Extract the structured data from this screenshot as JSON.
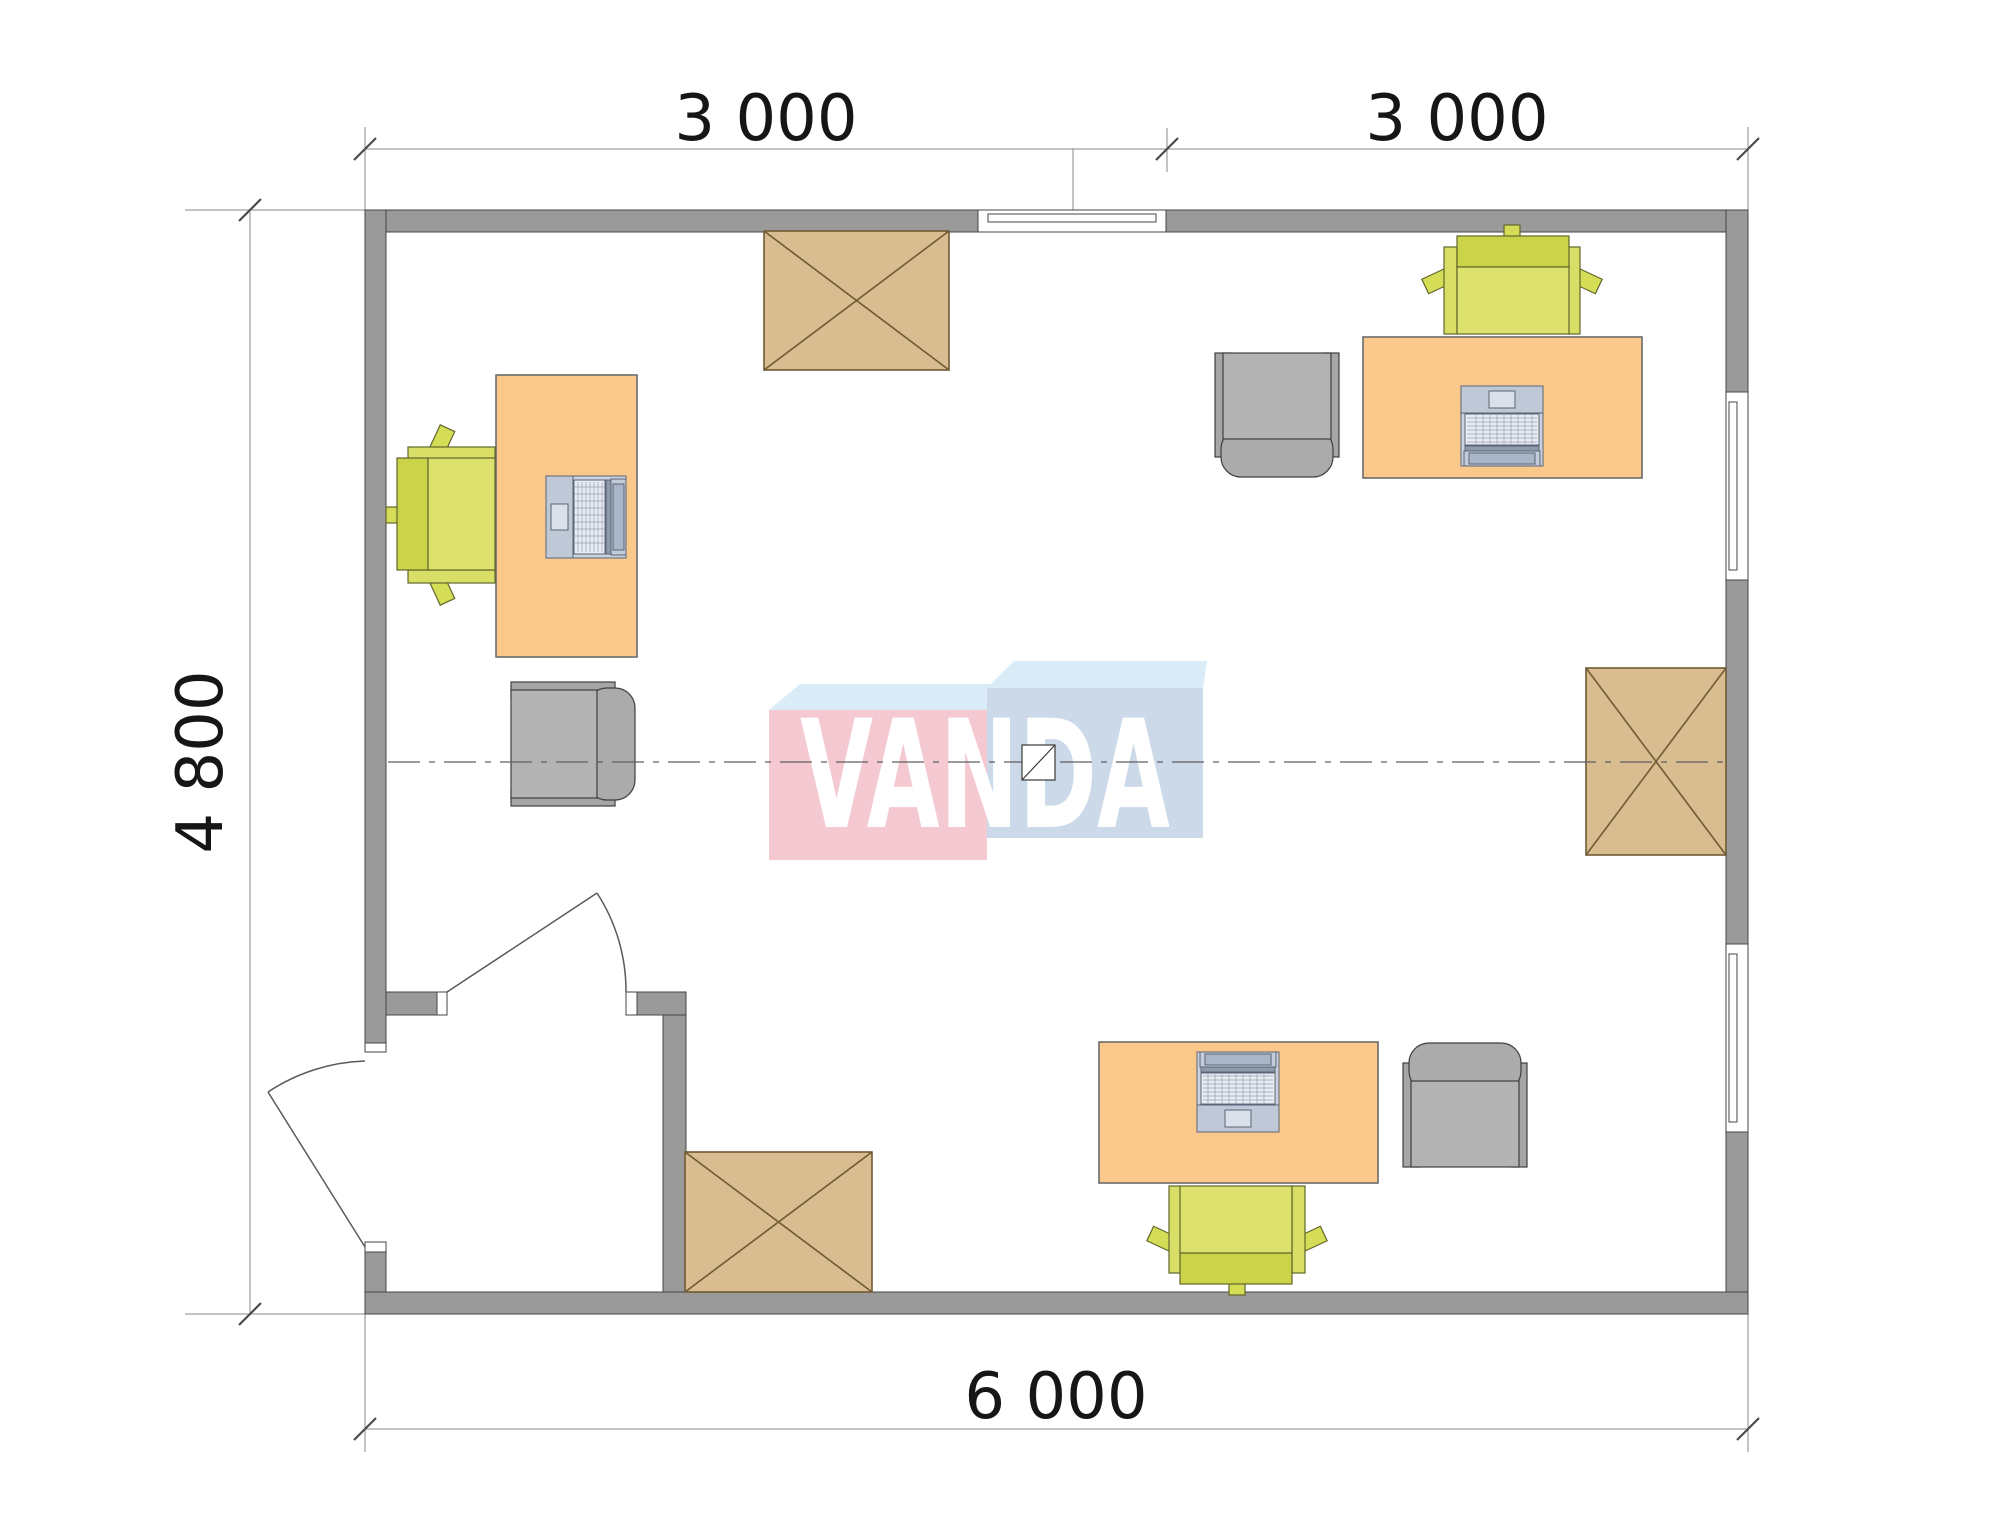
{
  "title": "Modular office floor plan 6000 x 4800 with furniture layout",
  "watermark": {
    "text": "VANDA"
  },
  "dimensions": {
    "top": {
      "segments": [
        {
          "label": "3 000"
        },
        {
          "label": "3 000"
        }
      ]
    },
    "left": {
      "label": "4 800"
    },
    "bottom": {
      "label": "6 000"
    }
  },
  "colors": {
    "wall": "#9A9A9A",
    "desk": "#FBC88B",
    "chair_green": "#D5DC55",
    "chair_green_back": "#CBD348",
    "chair_green_seat": "#DDE26F",
    "chair_green_armrest": "#D9DF66",
    "chair_gray": "#B3B3B3",
    "table_wood": "#D9BC90",
    "logo_pink": "#F4C9D1",
    "logo_blue": "#CBD9E9",
    "logo_top_face": "#D9ECF8",
    "dimension_text": "#161616",
    "centerline": "#5f5f5f"
  },
  "plan": {
    "rooms": [
      {
        "name": "main-office"
      },
      {
        "name": "entry-vestibule"
      }
    ],
    "symbols": [
      "desk",
      "office-chair",
      "guest-armchair",
      "laptop",
      "crossed-table",
      "window",
      "door-swing",
      "centerline",
      "module-joint-symbol"
    ],
    "counts": {
      "desks": 3,
      "office_chairs": 3,
      "guest_armchairs": 3,
      "laptops": 3,
      "crossed_tables": 3,
      "windows": 3,
      "doors": 2
    }
  }
}
